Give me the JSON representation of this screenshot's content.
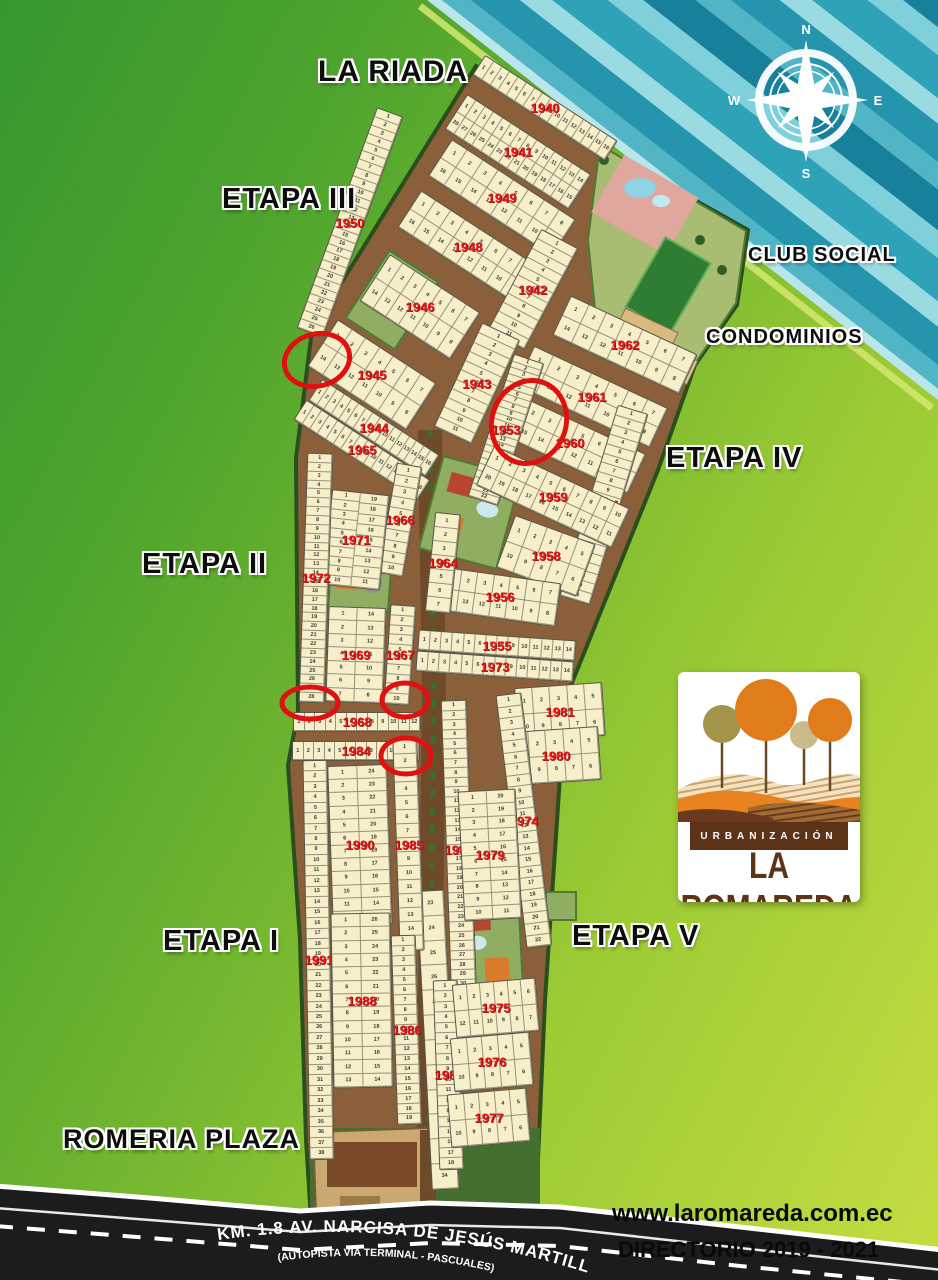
{
  "header": {
    "area_title": "LA RIADA"
  },
  "labels": {
    "la_riada": "LA RIADA",
    "etapa_iii": "ETAPA III",
    "club_social": "CLUB SOCIAL",
    "condominios": "CONDOMINIOS",
    "etapa_iv": "ETAPA IV",
    "etapa_ii": "ETAPA II",
    "etapa_i": "ETAPA I",
    "etapa_v": "ETAPA V",
    "romeria_plaza": "ROMERIA PLAZA"
  },
  "compass": {
    "n": "N",
    "e": "E",
    "s": "S",
    "w": "W"
  },
  "logo": {
    "line1": "URBANIZACIÓN",
    "line2": "LA ROMAREDA"
  },
  "footer": {
    "website": "www.laromareda.com.ec",
    "directory": "DIRECTORIO 2019 - 2021"
  },
  "road": {
    "name": "KM. 1.8 AV. NARCISA DE JESÚS MARTILLO",
    "subtitle": "(AUTOPISTA VIA TERMINAL - PASCUALES)"
  },
  "colors": {
    "street_brown": "#8a5f3a",
    "lot_cream": "#f7efc9",
    "block_number_red": "#e11b1b",
    "boundary_green": "#2a4f1d",
    "water_teal": "#2495ad",
    "road_black": "#1c1c1f",
    "logo_brown": "#5c3317",
    "logo_orange": "#e07c1c",
    "logo_olive": "#a3944a"
  },
  "map_blocks": [
    {
      "n": "1940",
      "x": 545,
      "y": 108,
      "w": 158,
      "h": 24,
      "r": 33,
      "lots": 16,
      "lay": "h1"
    },
    {
      "n": "1941",
      "x": 518,
      "y": 152,
      "w": 148,
      "h": 42,
      "r": 33,
      "lots": 28,
      "lay": "h2"
    },
    {
      "n": "1949",
      "x": 502,
      "y": 198,
      "w": 148,
      "h": 44,
      "r": 33,
      "lots": 16,
      "lay": "h2"
    },
    {
      "n": "1948",
      "x": 468,
      "y": 247,
      "w": 140,
      "h": 44,
      "r": 33,
      "lots": 16,
      "lay": "h2"
    },
    {
      "n": "1950",
      "x": 350,
      "y": 222,
      "w": 28,
      "h": 235,
      "r": 20,
      "lots": 26,
      "lay": "v1"
    },
    {
      "n": "1942",
      "x": 533,
      "y": 289,
      "w": 42,
      "h": 115,
      "r": 28,
      "lots": 11,
      "lay": "v1"
    },
    {
      "n": "1946",
      "x": 420,
      "y": 307,
      "w": 108,
      "h": 56,
      "r": 33,
      "lots": 14,
      "lay": "h2"
    },
    {
      "n": "1945",
      "x": 372,
      "y": 375,
      "w": 118,
      "h": 56,
      "r": 33,
      "lots": 14,
      "lay": "h2"
    },
    {
      "n": "1943",
      "x": 477,
      "y": 383,
      "w": 42,
      "h": 115,
      "r": 25,
      "lots": 11,
      "lay": "v1"
    },
    {
      "n": "1944",
      "x": 374,
      "y": 428,
      "w": 140,
      "h": 26,
      "r": 33,
      "lots": 16,
      "lay": "h1"
    },
    {
      "n": "1965",
      "x": 362,
      "y": 450,
      "w": 148,
      "h": 24,
      "r": 33,
      "lots": 16,
      "lay": "h1"
    },
    {
      "n": "1962",
      "x": 625,
      "y": 345,
      "w": 140,
      "h": 44,
      "r": 25,
      "lots": 14,
      "lay": "h2"
    },
    {
      "n": "1961",
      "x": 592,
      "y": 397,
      "w": 148,
      "h": 44,
      "r": 25,
      "lots": 14,
      "lay": "h2"
    },
    {
      "n": "1960",
      "x": 570,
      "y": 443,
      "w": 148,
      "h": 44,
      "r": 25,
      "lots": 16,
      "lay": "h2"
    },
    {
      "n": "1953",
      "x": 506,
      "y": 430,
      "w": 32,
      "h": 150,
      "r": 18,
      "lots": 22,
      "lay": "v1"
    },
    {
      "n": "1954",
      "x": 604,
      "y": 505,
      "w": 32,
      "h": 200,
      "r": 17,
      "lots": 20,
      "lay": "v1"
    },
    {
      "n": "1959",
      "x": 553,
      "y": 497,
      "w": 150,
      "h": 44,
      "r": 25,
      "lots": 20,
      "lay": "h2"
    },
    {
      "n": "1958",
      "x": 546,
      "y": 556,
      "w": 86,
      "h": 56,
      "r": 20,
      "lots": 10,
      "lay": "h2"
    },
    {
      "n": "1956",
      "x": 500,
      "y": 597,
      "w": 118,
      "h": 44,
      "r": 8,
      "lots": 14,
      "lay": "h2"
    },
    {
      "n": "1955",
      "x": 497,
      "y": 645,
      "w": 158,
      "h": 21,
      "r": 4,
      "lots": 14,
      "lay": "h1"
    },
    {
      "n": "1973",
      "x": 495,
      "y": 666,
      "w": 158,
      "h": 21,
      "r": 4,
      "lots": 14,
      "lay": "h1"
    },
    {
      "n": "1966",
      "x": 400,
      "y": 520,
      "w": 26,
      "h": 112,
      "r": 10,
      "lots": 10,
      "lay": "v1"
    },
    {
      "n": "1964",
      "x": 443,
      "y": 563,
      "w": 26,
      "h": 100,
      "r": 6,
      "lots": 7,
      "lay": "v1"
    },
    {
      "n": "1971",
      "x": 356,
      "y": 540,
      "w": 58,
      "h": 96,
      "r": 6,
      "lots": 19,
      "lay": "v2"
    },
    {
      "n": "1972",
      "x": 316,
      "y": 578,
      "w": 26,
      "h": 250,
      "r": 2,
      "lots": 28,
      "lay": "v1"
    },
    {
      "n": "1969",
      "x": 356,
      "y": 655,
      "w": 58,
      "h": 96,
      "r": 2,
      "lots": 14,
      "lay": "v2"
    },
    {
      "n": "1967",
      "x": 400,
      "y": 655,
      "w": 26,
      "h": 100,
      "r": 4,
      "lots": 10,
      "lay": "v1"
    },
    {
      "n": "1968",
      "x": 357,
      "y": 722,
      "w": 128,
      "h": 20,
      "r": 0,
      "lots": 12,
      "lay": "h1"
    },
    {
      "n": "1984",
      "x": 356,
      "y": 751,
      "w": 128,
      "h": 20,
      "r": 0,
      "lots": 12,
      "lay": "h1"
    },
    {
      "n": "1981",
      "x": 560,
      "y": 712,
      "w": 88,
      "h": 54,
      "r": -4,
      "lots": 10,
      "lay": "h2"
    },
    {
      "n": "1980",
      "x": 556,
      "y": 756,
      "w": 88,
      "h": 54,
      "r": -4,
      "lots": 10,
      "lay": "h2"
    },
    {
      "n": "1982",
      "x": 459,
      "y": 850,
      "w": 26,
      "h": 300,
      "r": -2,
      "lots": 31,
      "lay": "v1"
    },
    {
      "n": "1974",
      "x": 524,
      "y": 820,
      "w": 26,
      "h": 255,
      "r": -7,
      "lots": 22,
      "lay": "v1"
    },
    {
      "n": null,
      "x": 438,
      "y": 1040,
      "w": 28,
      "h": 300,
      "r": -3,
      "lots": 12,
      "start": 23,
      "lay": "v1"
    },
    {
      "n": "1985",
      "x": 408,
      "y": 845,
      "w": 25,
      "h": 212,
      "r": -2,
      "lots": 15,
      "lay": "v1"
    },
    {
      "n": "1990",
      "x": 360,
      "y": 845,
      "w": 60,
      "h": 160,
      "r": -2,
      "lots": 24,
      "lay": "v2"
    },
    {
      "n": "1979",
      "x": 490,
      "y": 855,
      "w": 58,
      "h": 130,
      "r": -3,
      "lots": 20,
      "lay": "v2"
    },
    {
      "n": "1991",
      "x": 318,
      "y": 960,
      "w": 25,
      "h": 400,
      "r": -1,
      "lots": 38,
      "lay": "v1"
    },
    {
      "n": "1988",
      "x": 362,
      "y": 1000,
      "w": 60,
      "h": 175,
      "r": -1,
      "lots": 26,
      "lay": "v2"
    },
    {
      "n": "1986",
      "x": 406,
      "y": 1030,
      "w": 25,
      "h": 190,
      "r": -2,
      "lots": 19,
      "lay": "v1"
    },
    {
      "n": "1983",
      "x": 448,
      "y": 1075,
      "w": 25,
      "h": 190,
      "r": -2,
      "lots": 18,
      "lay": "v1"
    },
    {
      "n": "1975",
      "x": 496,
      "y": 1008,
      "w": 84,
      "h": 54,
      "r": -5,
      "lots": 12,
      "lay": "h2"
    },
    {
      "n": "1976",
      "x": 492,
      "y": 1062,
      "w": 80,
      "h": 54,
      "r": -5,
      "lots": 10,
      "lay": "h2"
    },
    {
      "n": "1977",
      "x": 489,
      "y": 1118,
      "w": 80,
      "h": 54,
      "r": -5,
      "lots": 10,
      "lay": "h2"
    }
  ],
  "marker_circles": [
    {
      "x": 317,
      "y": 360,
      "rx": 33,
      "ry": 26,
      "r": -15
    },
    {
      "x": 529,
      "y": 422,
      "rx": 37,
      "ry": 42,
      "r": 20
    },
    {
      "x": 310,
      "y": 703,
      "rx": 28,
      "ry": 16,
      "r": 0
    },
    {
      "x": 405,
      "y": 700,
      "rx": 23,
      "ry": 17,
      "r": 0
    },
    {
      "x": 406,
      "y": 756,
      "rx": 25,
      "ry": 18,
      "r": 0
    }
  ]
}
